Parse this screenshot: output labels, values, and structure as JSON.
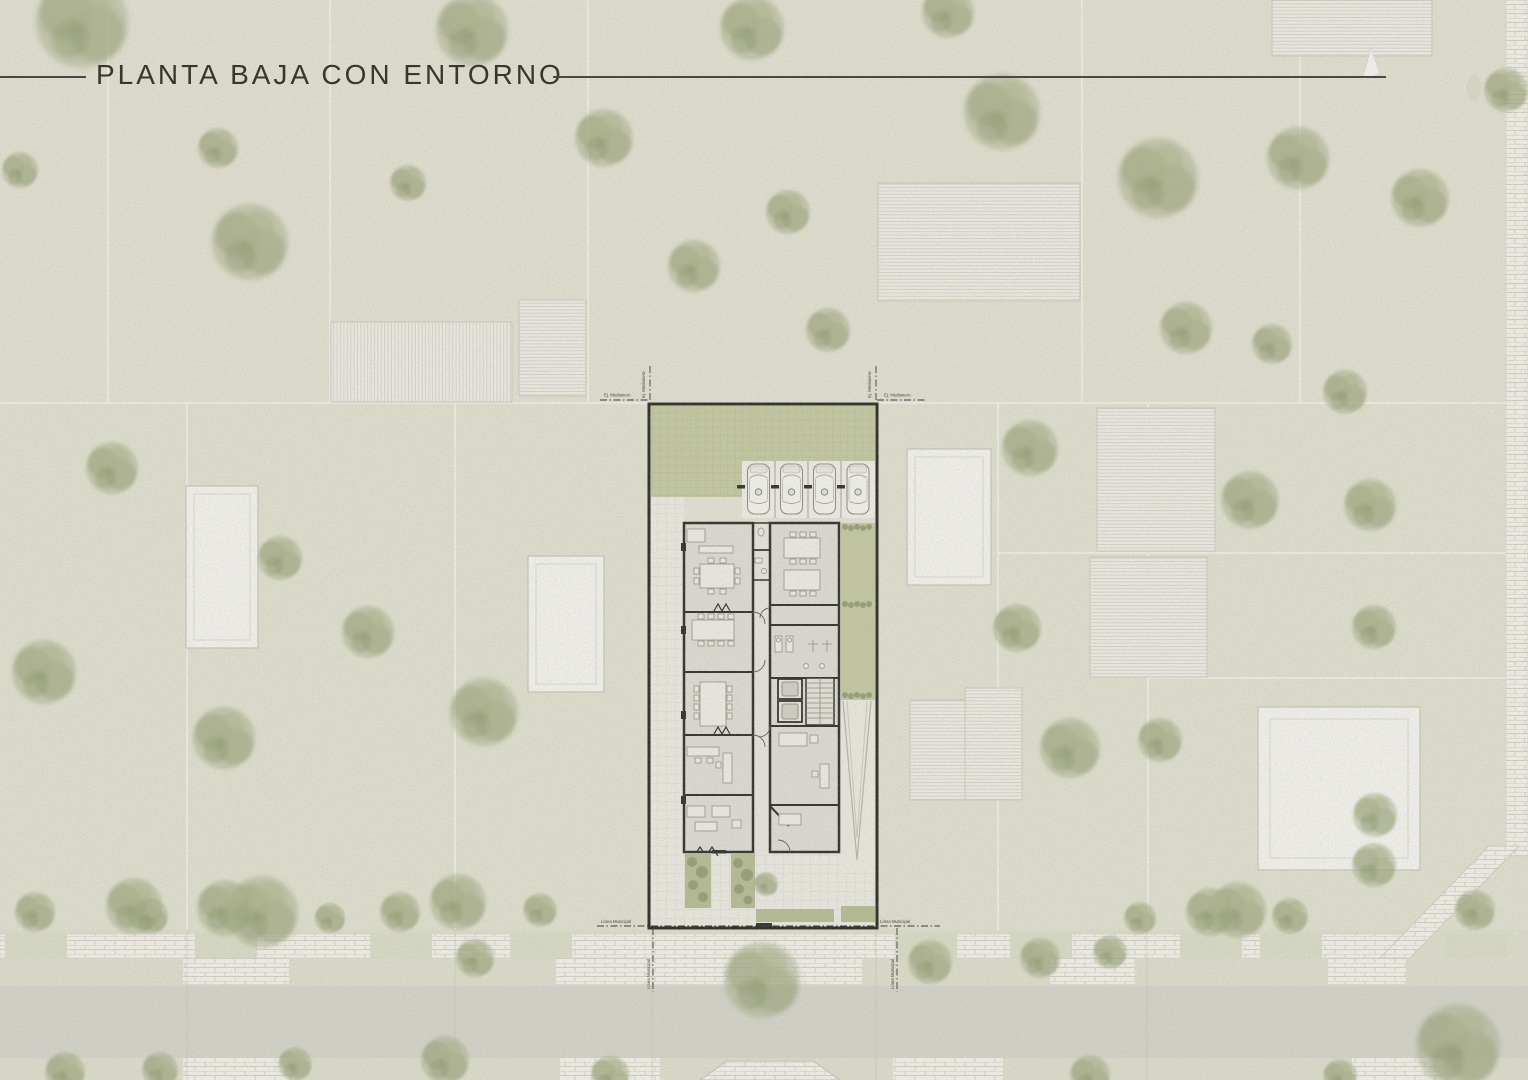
{
  "page": {
    "title": "PLANTA BAJA CON ENTORNO"
  },
  "plan": {
    "labels": {
      "party_wall_axis": "Ej. Medianero",
      "municipal_line": "Línea Municipal"
    },
    "site": {
      "parking_cars_visible": 4,
      "pools_visible": 4
    },
    "colors": {
      "paper": "#e9e8d9",
      "lawn": "#c7cda3",
      "tree": "#a3ad83",
      "street": "#dadad3",
      "paver": "#fcfbf6",
      "hatch_bg": "#f8f6f1",
      "hatch_line": "#ddd8d0",
      "wall": "#1c1c1a",
      "floor": "#e4e4de",
      "title_text": "#39372d"
    }
  }
}
